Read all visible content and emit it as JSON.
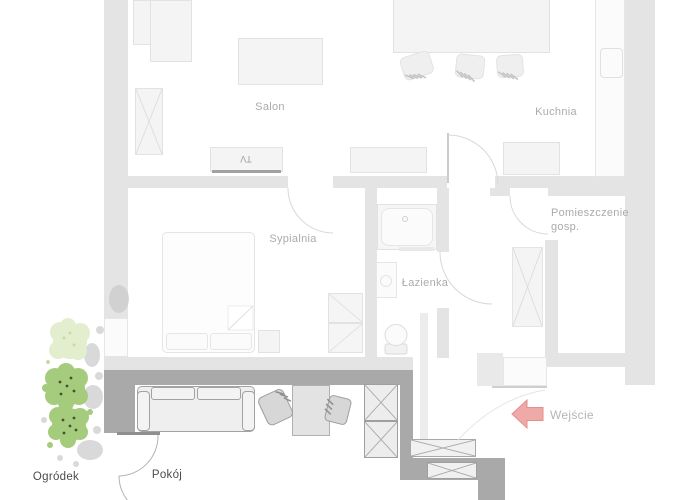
{
  "floorplan": {
    "title": "apartment-floor-plan",
    "rooms": {
      "salon": {
        "label": "Salon"
      },
      "kitchen": {
        "label": "Kuchnia"
      },
      "bedroom": {
        "label": "Sypialnia"
      },
      "bathroom": {
        "label": "Łazienka"
      },
      "utility": {
        "label_line1": "Pomieszczenie",
        "label_line2": "gosp."
      },
      "room": {
        "label": "Pokój"
      },
      "garden": {
        "label": "Ogródek"
      }
    },
    "entrance": {
      "label": "Wejście",
      "arrow_color": "#efa9a6",
      "arrow_direction": "left"
    },
    "tv_label": "TV",
    "colors": {
      "background": "#ffffff",
      "wall_faded": "#e4e4e4",
      "wall_highlighted": "#a9a9a9",
      "furniture_faded_fill": "#f4f4f4",
      "room_label_text": "#ababab",
      "dark_label_text": "#4b4b4b",
      "entrance_arrow": "#efa9a6",
      "tree_green": "#a5cc7c",
      "tree_pale": "#e2eecd",
      "tree_shadow": "#c9c9c9"
    }
  }
}
